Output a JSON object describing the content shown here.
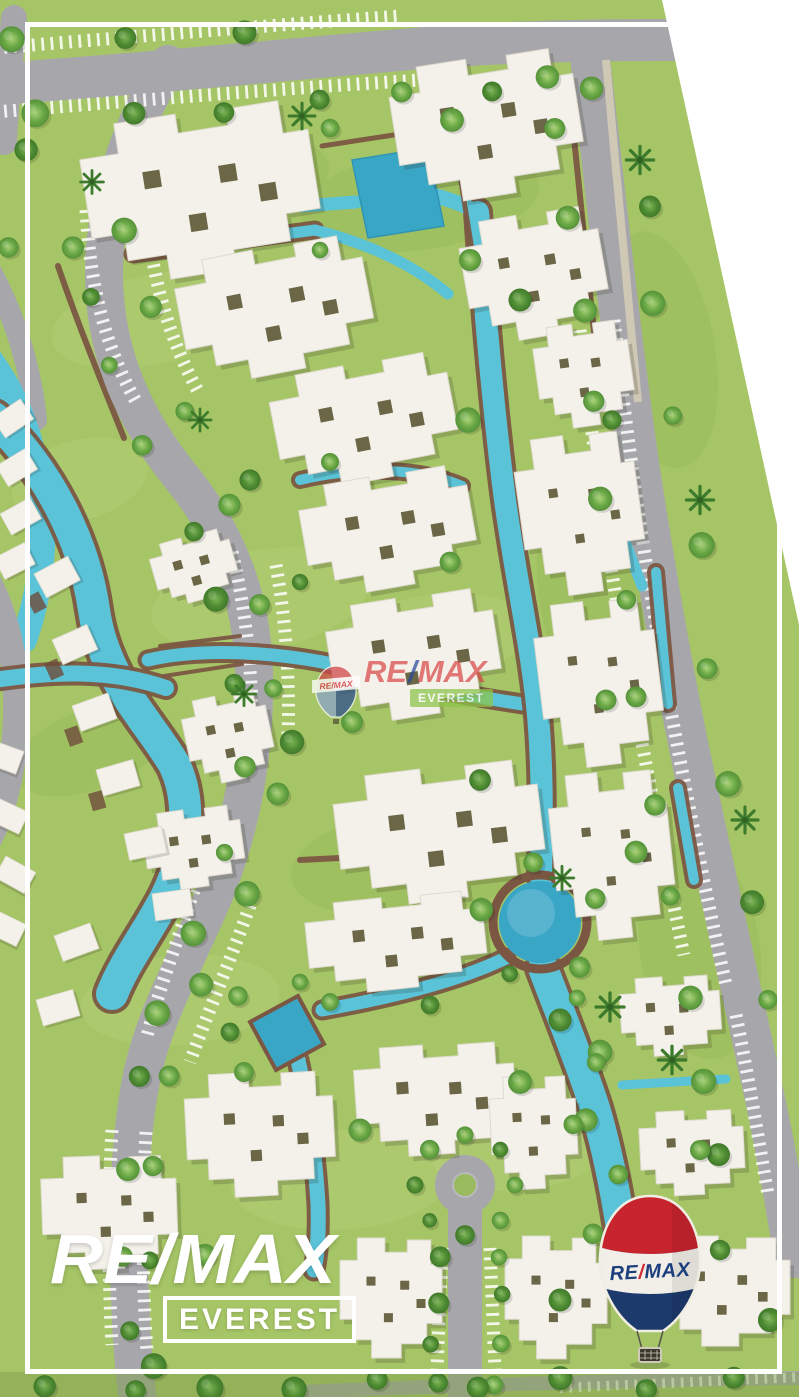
{
  "brand": {
    "watermark": {
      "banner": "RE/MAX",
      "re": "RE",
      "slash": "/",
      "max": "MAX",
      "sub": "EVEREST"
    },
    "logo": {
      "name": "RE/MAX",
      "sub": "EVEREST"
    },
    "balloon": {
      "re": "RE",
      "slash": "/",
      "max": "MAX"
    }
  },
  "icons": {
    "watermark_balloon": "remax-balloon-icon",
    "corner_balloon": "remax-balloon-icon"
  },
  "palette": {
    "grass": "#a6c566",
    "grass_light": "#c6dc92",
    "grass_dark": "#86ad4d",
    "water": "#5ac3d8",
    "water_deep": "#3aa6c6",
    "road": "#a7a7ab",
    "road_light": "#b9b9bd",
    "stripe": "#ffffff",
    "path_brown": "#7b5743",
    "sidewalk": "#cfc8b5",
    "building": "#f3f1ea",
    "building_edge": "#dedacf",
    "courtyard": "#57522f",
    "tree_dark": "#4f8c33",
    "frame": "#ffffff",
    "blank": "#ffffff",
    "remax_red": "#c8242e",
    "remax_blue": "#1d3a6d",
    "remax_text_blue": "#1c3f7c",
    "everest_green": "#8dc44a"
  }
}
